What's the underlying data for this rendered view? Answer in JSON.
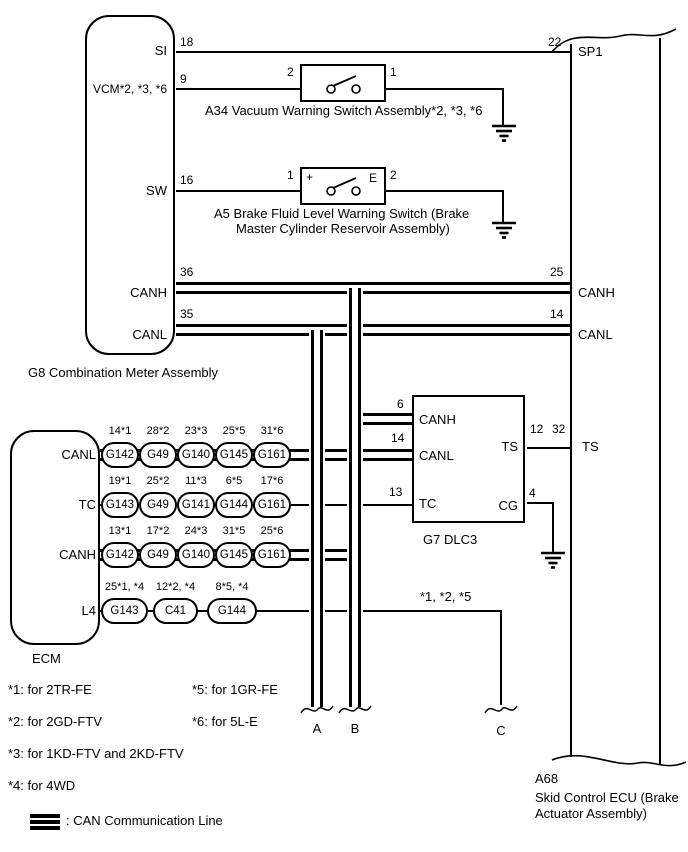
{
  "g8": {
    "caption": "G8   Combination Meter Assembly",
    "pins": {
      "si": {
        "name": "SI",
        "num": "18"
      },
      "vcm": {
        "name": "VCM*2, *3, *6",
        "num": "9"
      },
      "sw": {
        "name": "SW",
        "num": "16"
      },
      "canh": {
        "name": "CANH",
        "num": "36"
      },
      "canl": {
        "name": "CANL",
        "num": "35"
      }
    }
  },
  "a34": {
    "caption": "A34   Vacuum Warning Switch Assembly*2, *3, *6",
    "pin_left": "2",
    "pin_right": "1"
  },
  "a5": {
    "caption_line1": "A5   Brake Fluid Level Warning Switch (Brake",
    "caption_line2": "Master Cylinder Reservoir Assembly)",
    "pin_left": "1",
    "pin_right": "2",
    "plus_terminal": "+",
    "e_terminal": "E"
  },
  "a68": {
    "id": "A68",
    "caption_line1": "Skid Control ECU (Brake",
    "caption_line2": "Actuator Assembly)",
    "pins": {
      "sp1": {
        "num": "22",
        "name": "SP1"
      },
      "canh": {
        "num": "25",
        "name": "CANH"
      },
      "canl": {
        "num": "14",
        "name": "CANL"
      },
      "ts": {
        "num": "32",
        "name": "TS"
      }
    }
  },
  "g7": {
    "caption": "G7   DLC3",
    "left_pins": {
      "canh": {
        "num": "6",
        "name": "CANH"
      },
      "canl": {
        "num": "14",
        "name": "CANL"
      },
      "tc": {
        "num": "13",
        "name": "TC"
      }
    },
    "right_pins": {
      "ts": {
        "num": "12",
        "name": "TS"
      },
      "cg": {
        "num": "4",
        "name": "CG"
      }
    }
  },
  "ecm": {
    "caption": "ECM",
    "rows": [
      {
        "name": "CANL",
        "connectors": [
          {
            "pin": "14*1",
            "label": "G142"
          },
          {
            "pin": "28*2",
            "label": "G49"
          },
          {
            "pin": "23*3",
            "label": "G140"
          },
          {
            "pin": "25*5",
            "label": "G145"
          },
          {
            "pin": "31*6",
            "label": "G161"
          }
        ]
      },
      {
        "name": "TC",
        "connectors": [
          {
            "pin": "19*1",
            "label": "G143"
          },
          {
            "pin": "25*2",
            "label": "G49"
          },
          {
            "pin": "11*3",
            "label": "G141"
          },
          {
            "pin": "6*5",
            "label": "G144"
          },
          {
            "pin": "17*6",
            "label": "G161"
          }
        ]
      },
      {
        "name": "CANH",
        "connectors": [
          {
            "pin": "13*1",
            "label": "G142"
          },
          {
            "pin": "17*2",
            "label": "G49"
          },
          {
            "pin": "24*3",
            "label": "G140"
          },
          {
            "pin": "31*5",
            "label": "G145"
          },
          {
            "pin": "25*6",
            "label": "G161"
          }
        ]
      },
      {
        "name": "L4",
        "connectors": [
          {
            "pin": "25*1, *4",
            "label": "G143"
          },
          {
            "pin": "12*2, *4",
            "label": "C41"
          },
          {
            "pin": "8*5, *4",
            "label": "G144"
          }
        ]
      }
    ]
  },
  "branches": {
    "a": "A",
    "b": "B",
    "c": "C",
    "l4_note": "*1, *2, *5"
  },
  "notes": [
    "*1: for 2TR-FE",
    "*2: for 2GD-FTV",
    "*3: for 1KD-FTV and 2KD-FTV",
    "*4: for 4WD",
    "*5: for 1GR-FE",
    "*6: for 5L-E"
  ],
  "legend": {
    "label": ": CAN Communication Line"
  },
  "colors": {
    "line": "#000000",
    "background": "#ffffff"
  }
}
